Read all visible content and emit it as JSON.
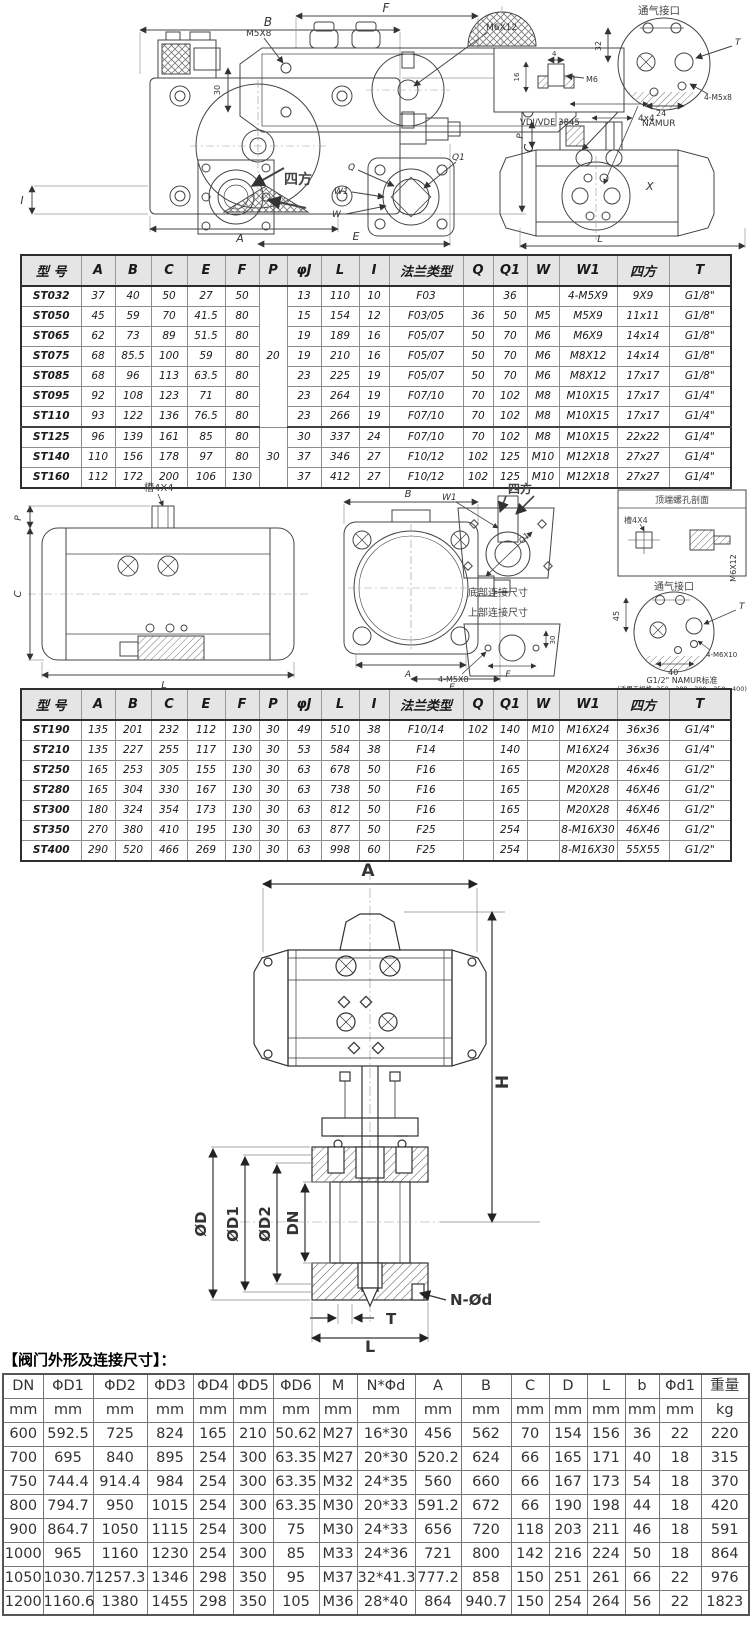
{
  "drawings": {
    "panel1": {
      "B": "B",
      "C": "C",
      "A": "A",
      "E": "E",
      "I": "I",
      "F": "F",
      "m5x8": "M5X8",
      "m6x12": "M6X12",
      "d30": "30",
      "sifang": "四方",
      "Q": "Q",
      "Q1": "Q1",
      "W": "W",
      "W1": "W1",
      "d4": "4",
      "d16": "16",
      "M6": "M6",
      "vdivde": "VDI/VDE 3845",
      "vent": "通气接口",
      "T": "T",
      "d32": "32",
      "d24": "24",
      "m5x8_4": "4-M5x8",
      "namur": "NAMUR",
      "d4x4": "4x4",
      "P": "P",
      "X": "X",
      "L": "L"
    },
    "panel2": {
      "cao4x4": "槽4X4",
      "P": "P",
      "C": "C",
      "L": "L",
      "B": "B",
      "A": "A",
      "E": "E",
      "sifang": "四方",
      "W1": "W1",
      "Q1": "Q1",
      "bottom_conn": "底部连接尺寸",
      "top_conn": "上部连接尺寸",
      "m5x8_4": "4-M5X8",
      "F": "F",
      "d30": "30",
      "top_section": "顶端螺孔剖面",
      "cao4x4b": "槽4X4",
      "m6x12": "M6X12",
      "vent": "通气接口",
      "d45": "45",
      "d40": "40",
      "T": "T",
      "m6x10_4": "4-M6X10",
      "namur_std": "G1/2\" NAMUR标准",
      "namur_note": "(适用于规格: 250、280、300、350、400)"
    },
    "panel3": {
      "A": "A",
      "H": "H",
      "OD": "ØD",
      "OD1": "ØD1",
      "OD2": "ØD2",
      "DN": "DN",
      "NOd": "N-Ød",
      "T": "T",
      "L": "L"
    }
  },
  "tables": {
    "spec1": {
      "headers": [
        "型 号",
        "A",
        "B",
        "C",
        "E",
        "F",
        "P",
        "φJ",
        "L",
        "I",
        "法兰类型",
        "Q",
        "Q1",
        "W",
        "W1",
        "四方",
        "T"
      ],
      "rows": [
        [
          "ST032",
          "37",
          "40",
          "50",
          "27",
          "50",
          {
            "v": "20",
            "span": 7
          },
          "13",
          "110",
          "10",
          "F03",
          "",
          "36",
          "",
          "4-M5X9",
          "9X9",
          "G1/8\""
        ],
        [
          "ST050",
          "45",
          "59",
          "70",
          "41.5",
          "80",
          "15",
          "154",
          "12",
          "F03/05",
          "36",
          "50",
          "M5",
          "M5X9",
          "11x11",
          "G1/8\""
        ],
        [
          "ST065",
          "62",
          "73",
          "89",
          "51.5",
          "80",
          "19",
          "189",
          "16",
          "F05/07",
          "50",
          "70",
          "M6",
          "M6X9",
          "14x14",
          "G1/8\""
        ],
        [
          "ST075",
          "68",
          "85.5",
          "100",
          "59",
          "80",
          "19",
          "210",
          "16",
          "F05/07",
          "50",
          "70",
          "M6",
          "M8X12",
          "14x14",
          "G1/8\""
        ],
        [
          "ST085",
          "68",
          "96",
          "113",
          "63.5",
          "80",
          "23",
          "225",
          "19",
          "F05/07",
          "50",
          "70",
          "M6",
          "M8X12",
          "17x17",
          "G1/8\""
        ],
        [
          "ST095",
          "92",
          "108",
          "123",
          "71",
          "80",
          "23",
          "264",
          "19",
          "F07/10",
          "70",
          "102",
          "M8",
          "M10X15",
          "17x17",
          "G1/4\""
        ],
        [
          "ST110",
          "93",
          "122",
          "136",
          "76.5",
          "80",
          "23",
          "266",
          "19",
          "F07/10",
          "70",
          "102",
          "M8",
          "M10X15",
          "17x17",
          "G1/4\""
        ],
        [
          "ST125",
          "96",
          "139",
          "161",
          "85",
          "80",
          {
            "v": "30",
            "span": 3
          },
          "30",
          "337",
          "24",
          "F07/10",
          "70",
          "102",
          "M8",
          "M10X15",
          "22x22",
          "G1/4\""
        ],
        [
          "ST140",
          "110",
          "156",
          "178",
          "97",
          "80",
          "37",
          "346",
          "27",
          "F10/12",
          "102",
          "125",
          "M10",
          "M12X18",
          "27x27",
          "G1/4\""
        ],
        [
          "ST160",
          "112",
          "172",
          "200",
          "106",
          "130",
          "37",
          "412",
          "27",
          "F10/12",
          "102",
          "125",
          "M10",
          "M12X18",
          "27x27",
          "G1/4\""
        ]
      ]
    },
    "spec2": {
      "headers": [
        "型 号",
        "A",
        "B",
        "C",
        "E",
        "F",
        "P",
        "φJ",
        "L",
        "I",
        "法兰类型",
        "Q",
        "Q1",
        "W",
        "W1",
        "四方",
        "T"
      ],
      "rows": [
        [
          "ST190",
          "135",
          "201",
          "232",
          "112",
          "130",
          "30",
          "49",
          "510",
          "38",
          "F10/14",
          "102",
          "140",
          "M10",
          "M16X24",
          "36x36",
          "G1/4\""
        ],
        [
          "ST210",
          "135",
          "227",
          "255",
          "117",
          "130",
          "30",
          "53",
          "584",
          "38",
          "F14",
          "",
          "140",
          "",
          "M16X24",
          "36x36",
          "G1/4\""
        ],
        [
          "ST250",
          "165",
          "253",
          "305",
          "155",
          "130",
          "30",
          "63",
          "678",
          "50",
          "F16",
          "",
          "165",
          "",
          "M20X28",
          "46x46",
          "G1/2\""
        ],
        [
          "ST280",
          "165",
          "304",
          "330",
          "167",
          "130",
          "30",
          "63",
          "738",
          "50",
          "F16",
          "",
          "165",
          "",
          "M20X28",
          "46X46",
          "G1/2\""
        ],
        [
          "ST300",
          "180",
          "324",
          "354",
          "173",
          "130",
          "30",
          "63",
          "812",
          "50",
          "F16",
          "",
          "165",
          "",
          "M20X28",
          "46X46",
          "G1/2\""
        ],
        [
          "ST350",
          "270",
          "380",
          "410",
          "195",
          "130",
          "30",
          "63",
          "877",
          "50",
          "F25",
          "",
          "254",
          "",
          "8-M16X30",
          "46X46",
          "G1/2\""
        ],
        [
          "ST400",
          "290",
          "520",
          "466",
          "269",
          "130",
          "30",
          "63",
          "998",
          "60",
          "F25",
          "",
          "254",
          "",
          "8-M16X30",
          "55X55",
          "G1/2\""
        ]
      ]
    },
    "valve": {
      "title": "【阀门外形及连接尺寸】：",
      "headers": [
        "DN",
        "ΦD1",
        "ΦD2",
        "ΦD3",
        "ΦD4",
        "ΦD5",
        "ΦD6",
        "M",
        "N*Φd",
        "A",
        "B",
        "C",
        "D",
        "L",
        "b",
        "Φd1",
        "重量"
      ],
      "units": [
        "mm",
        "mm",
        "mm",
        "mm",
        "mm",
        "mm",
        "mm",
        "mm",
        "mm",
        "mm",
        "mm",
        "mm",
        "mm",
        "mm",
        "mm",
        "mm",
        "kg"
      ],
      "rows": [
        [
          "600",
          "592.5",
          "725",
          "824",
          "165",
          "210",
          "50.62",
          "M27",
          "16*30",
          "456",
          "562",
          "70",
          "154",
          "156",
          "36",
          "22",
          "220"
        ],
        [
          "700",
          "695",
          "840",
          "895",
          "254",
          "300",
          "63.35",
          "M27",
          "20*30",
          "520.2",
          "624",
          "66",
          "165",
          "171",
          "40",
          "18",
          "315"
        ],
        [
          "750",
          "744.4",
          "914.4",
          "984",
          "254",
          "300",
          "63.35",
          "M32",
          "24*35",
          "560",
          "660",
          "66",
          "167",
          "173",
          "54",
          "18",
          "370"
        ],
        [
          "800",
          "794.7",
          "950",
          "1015",
          "254",
          "300",
          "63.35",
          "M30",
          "20*33",
          "591.2",
          "672",
          "66",
          "190",
          "198",
          "44",
          "18",
          "420"
        ],
        [
          "900",
          "864.7",
          "1050",
          "1115",
          "254",
          "300",
          "75",
          "M30",
          "24*33",
          "656",
          "720",
          "118",
          "203",
          "211",
          "46",
          "18",
          "591"
        ],
        [
          "1000",
          "965",
          "1160",
          "1230",
          "254",
          "300",
          "85",
          "M33",
          "24*36",
          "721",
          "800",
          "142",
          "216",
          "224",
          "50",
          "18",
          "864"
        ],
        [
          "1050",
          "1030.7",
          "1257.3",
          "1346",
          "298",
          "350",
          "95",
          "M37",
          "32*41.3",
          "777.2",
          "858",
          "150",
          "251",
          "261",
          "66",
          "22",
          "976"
        ],
        [
          "1200",
          "1160.6",
          "1380",
          "1455",
          "298",
          "350",
          "105",
          "M36",
          "28*40",
          "864",
          "940.7",
          "150",
          "254",
          "264",
          "56",
          "22",
          "1823"
        ]
      ]
    }
  }
}
